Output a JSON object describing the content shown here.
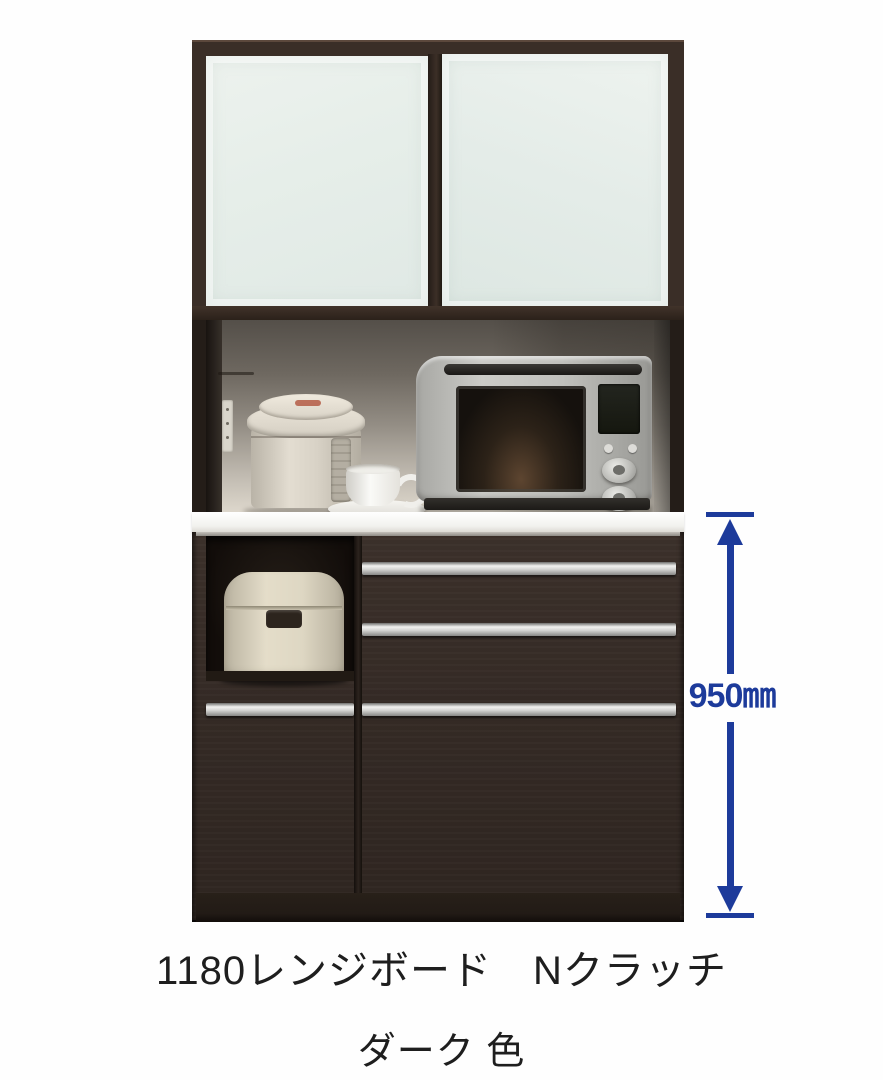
{
  "product": {
    "caption_line1": "1180レンジボード　Nクラッチ",
    "caption_line2": "ダーク 色",
    "dimension_label": "950㎜"
  },
  "scene": {
    "type": "furniture-product-photo",
    "sections": [
      "upper-cabinet-with-frosted-sliding-glass-doors",
      "open-counter-space-with-appliances",
      "white-countertop",
      "lower-drawer-cabinet-with-aluminum-handles",
      "open-niche-with-rice-cooker"
    ],
    "appliances": [
      "electric-thermo-pot",
      "coffee-cup-with-saucer",
      "microwave-oven",
      "rice-cooker"
    ]
  },
  "colors": {
    "cabinet_dark_brown": "#342a25",
    "frame_brown": "#3a2e27",
    "frosted_glass": "#e6eee9",
    "handle_silver": "#d7d7d5",
    "countertop_white": "#f2f2ee",
    "annotation_navy": "#1d3b9b",
    "caption_text": "#1e1e1e",
    "background": "#fefefe"
  }
}
